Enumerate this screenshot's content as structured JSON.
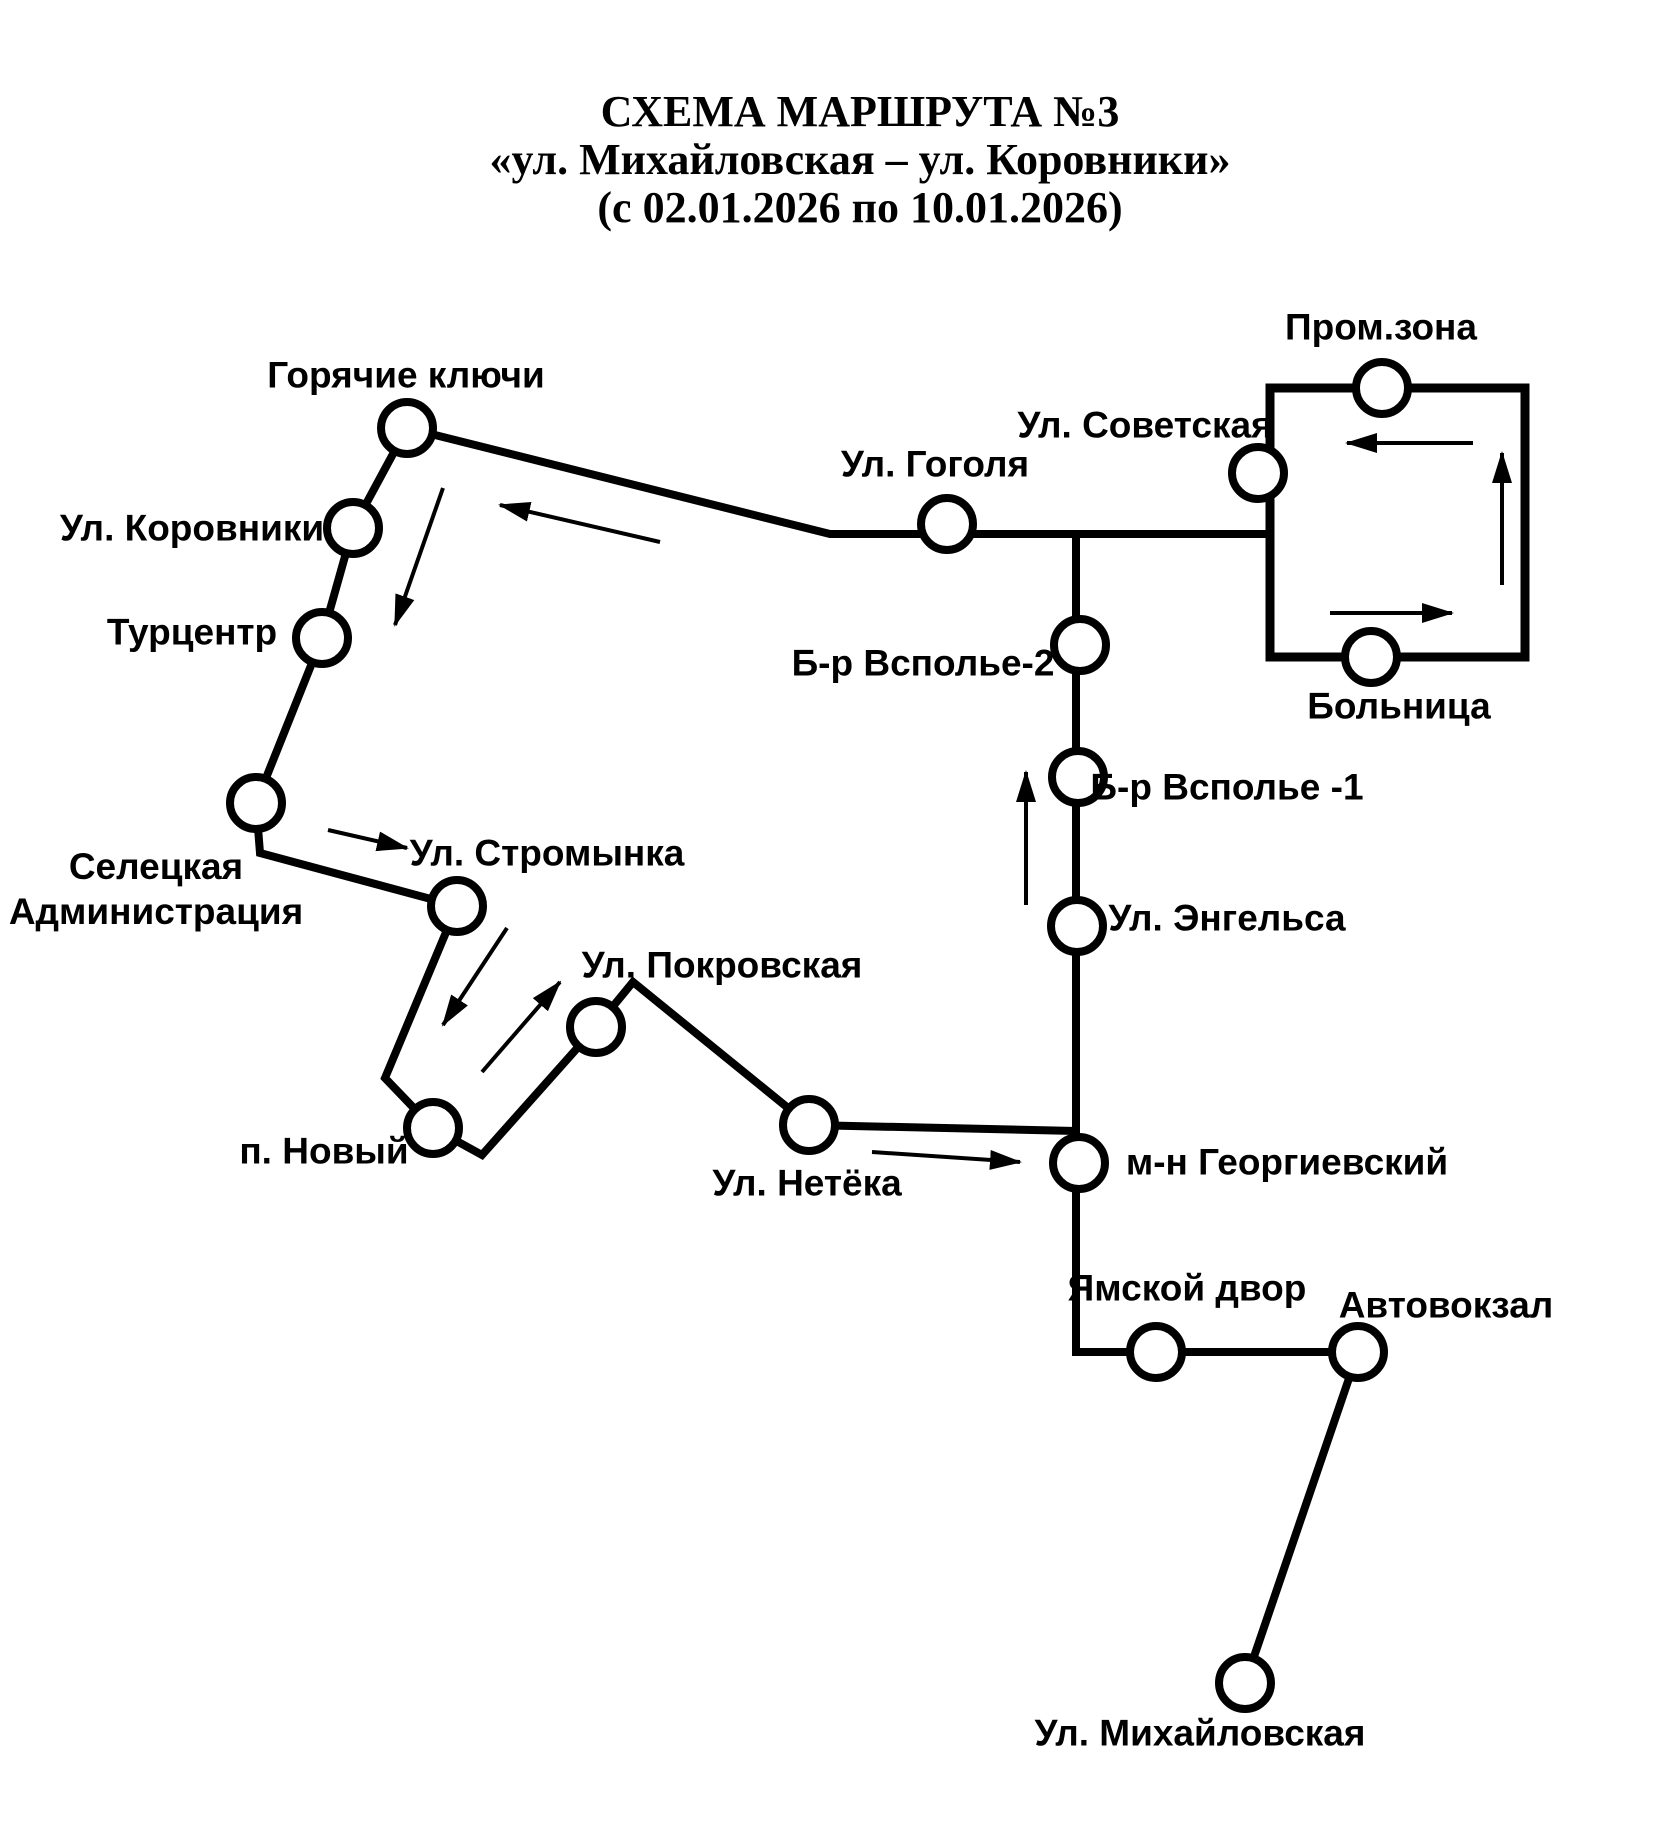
{
  "title": {
    "line1": "СХЕМА МАРШРУТА №3",
    "line2": "«ул. Михайловская – ул. Коровники»",
    "line3": "(с 02.01.2026 по 10.01.2026)"
  },
  "diagram": {
    "background_color": "#ffffff",
    "line_color": "#000000",
    "stop_fill_color": "#ffffff",
    "stop_radius": 26,
    "route_line_width": 8,
    "arrow_line_width": 4,
    "route_segments": [
      {
        "name": "klyuchi-to-loop-line",
        "points": [
          [
            407,
            428
          ],
          [
            830,
            534
          ],
          [
            1270,
            534
          ]
        ]
      },
      {
        "name": "klyuchi-to-netyoka-line",
        "points": [
          [
            407,
            428
          ],
          [
            353,
            528
          ],
          [
            322,
            638
          ],
          [
            256,
            803
          ],
          [
            260,
            853
          ],
          [
            457,
            906
          ],
          [
            385,
            1078
          ],
          [
            433,
            1128
          ],
          [
            482,
            1155
          ],
          [
            596,
            1027
          ],
          [
            633,
            982
          ],
          [
            809,
            1125
          ],
          [
            1076,
            1131
          ]
        ]
      },
      {
        "name": "vspole-to-mikhaylovskaya-line",
        "points": [
          [
            1076,
            534
          ],
          [
            1076,
            1352
          ],
          [
            1358,
            1352
          ],
          [
            1245,
            1683
          ]
        ]
      }
    ],
    "loop_rect": {
      "x": 1270,
      "y": 388,
      "width": 255,
      "height": 269,
      "line_width": 9
    },
    "arrows": [
      {
        "name": "arrow-to-klyuchi",
        "from": [
          660,
          542
        ],
        "to": [
          500,
          505
        ]
      },
      {
        "name": "arrow-klyuchi-down",
        "from": [
          443,
          488
        ],
        "to": [
          395,
          625
        ]
      },
      {
        "name": "arrow-to-stromynka",
        "from": [
          328,
          830
        ],
        "to": [
          407,
          848
        ]
      },
      {
        "name": "arrow-stromynka-down",
        "from": [
          507,
          928
        ],
        "to": [
          443,
          1025
        ]
      },
      {
        "name": "arrow-to-pokrovskaya",
        "from": [
          482,
          1072
        ],
        "to": [
          560,
          982
        ]
      },
      {
        "name": "arrow-to-georgievskiy",
        "from": [
          872,
          1152
        ],
        "to": [
          1020,
          1162
        ]
      },
      {
        "name": "arrow-vspole-up",
        "from": [
          1026,
          905
        ],
        "to": [
          1026,
          772
        ]
      },
      {
        "name": "arrow-loop-top-left",
        "from": [
          1473,
          443
        ],
        "to": [
          1347,
          443
        ]
      },
      {
        "name": "arrow-loop-right-up",
        "from": [
          1502,
          585
        ],
        "to": [
          1502,
          453
        ]
      },
      {
        "name": "arrow-loop-bottom-right",
        "from": [
          1330,
          613
        ],
        "to": [
          1452,
          613
        ]
      }
    ],
    "stops": [
      {
        "id": "goryachie-klyuchi",
        "x": 407,
        "y": 428,
        "label_cx": 406,
        "label_cy": 375,
        "label_lines": [
          "Горячие ключи"
        ]
      },
      {
        "id": "korovniki",
        "x": 353,
        "y": 528,
        "label_cx": 192,
        "label_cy": 528,
        "label_lines": [
          "Ул. Коровники"
        ]
      },
      {
        "id": "turtsentr",
        "x": 322,
        "y": 638,
        "label_cx": 192,
        "label_cy": 632,
        "label_lines": [
          "Турцентр"
        ]
      },
      {
        "id": "seletskaya-administratsiya",
        "x": 256,
        "y": 803,
        "label_cx": 156,
        "label_cy": 889,
        "label_lines": [
          "Селецкая",
          "Администрация"
        ]
      },
      {
        "id": "stromynka",
        "x": 457,
        "y": 906,
        "label_cx": 547,
        "label_cy": 853,
        "label_lines": [
          "Ул. Стромынка"
        ]
      },
      {
        "id": "pokrovskaya",
        "x": 596,
        "y": 1027,
        "label_cx": 722,
        "label_cy": 965,
        "label_lines": [
          "Ул. Покровская"
        ]
      },
      {
        "id": "novyy",
        "x": 433,
        "y": 1128,
        "label_cx": 324,
        "label_cy": 1151,
        "label_lines": [
          "п. Новый"
        ]
      },
      {
        "id": "netyoka",
        "x": 809,
        "y": 1125,
        "label_cx": 807,
        "label_cy": 1183,
        "label_lines": [
          "Ул. Нетёка"
        ]
      },
      {
        "id": "gogolya",
        "x": 947,
        "y": 524,
        "label_cx": 935,
        "label_cy": 464,
        "label_lines": [
          "Ул. Гоголя"
        ]
      },
      {
        "id": "vspole-2",
        "x": 1080,
        "y": 645,
        "label_cx": 923,
        "label_cy": 663,
        "label_lines": [
          "Б-р Всполье-2"
        ]
      },
      {
        "id": "vspole-1",
        "x": 1078,
        "y": 777,
        "label_cx": 1227,
        "label_cy": 787,
        "label_lines": [
          "Б-р Всполье -1"
        ]
      },
      {
        "id": "engelsa",
        "x": 1077,
        "y": 926,
        "label_cx": 1227,
        "label_cy": 918,
        "label_lines": [
          "Ул. Энгельса"
        ]
      },
      {
        "id": "georgievskiy",
        "x": 1079,
        "y": 1163,
        "label_cx": 1287,
        "label_cy": 1162,
        "label_lines": [
          "м-н Георгиевский"
        ]
      },
      {
        "id": "yamskoy-dvor",
        "x": 1156,
        "y": 1352,
        "label_cx": 1187,
        "label_cy": 1288,
        "label_lines": [
          "Ямской двор"
        ]
      },
      {
        "id": "avtovokzal",
        "x": 1358,
        "y": 1352,
        "label_cx": 1446,
        "label_cy": 1305,
        "label_lines": [
          "Автовокзал"
        ]
      },
      {
        "id": "mikhaylovskaya",
        "x": 1245,
        "y": 1683,
        "label_cx": 1200,
        "label_cy": 1733,
        "label_lines": [
          "Ул. Михайловская"
        ]
      },
      {
        "id": "sovetskaya",
        "x": 1258,
        "y": 473,
        "label_cx": 1145,
        "label_cy": 425,
        "label_lines": [
          "Ул. Советская"
        ]
      },
      {
        "id": "promzona",
        "x": 1382,
        "y": 388,
        "label_cx": 1381,
        "label_cy": 327,
        "label_lines": [
          "Пром.зона"
        ]
      },
      {
        "id": "bolnitsa",
        "x": 1371,
        "y": 657,
        "label_cx": 1399,
        "label_cy": 706,
        "label_lines": [
          "Больница"
        ]
      }
    ]
  }
}
